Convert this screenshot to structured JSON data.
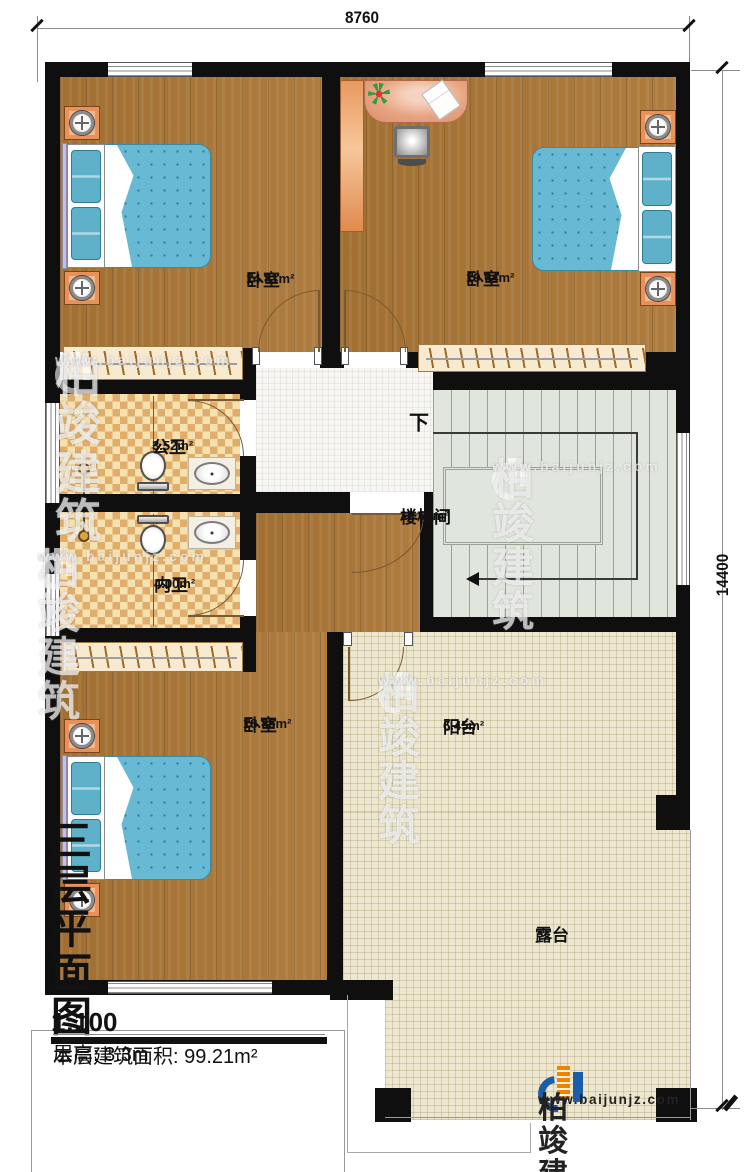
{
  "dimensions": {
    "top": "8760",
    "right": "14400"
  },
  "rooms": [
    {
      "name": "卧室",
      "area": "14.81m²"
    },
    {
      "name": "卧室",
      "area": "19.64m²"
    },
    {
      "name": "公卫",
      "area": "3.52m²"
    },
    {
      "name": "内卫",
      "area": "4.00m²"
    },
    {
      "name": "楼梯间",
      "area": "16.68m²"
    },
    {
      "name": "卧室",
      "area": "18.85m²"
    },
    {
      "name": "阳台",
      "area": "6.45m²"
    },
    {
      "name": "露台",
      "area": ""
    }
  ],
  "stairs": {
    "down_label": "下"
  },
  "title_block": {
    "title": "三层平面图",
    "scale": "1:100",
    "floor_area_label": "本层建筑面积: 99.21m²",
    "floor_height_label": "层高: 3.3m"
  },
  "branding": {
    "company": "柏竣建筑",
    "website": "www.baijunjz.com"
  },
  "colors": {
    "wall": "#0f0f0f",
    "wood_floor": "#a97534",
    "bath_tile_light": "#f6e2b0",
    "bath_tile_dark": "#e0ad6b",
    "stair_floor": "#e0e5dd",
    "outdoor_floor": "#ece7ce",
    "bed": "#68b9d4",
    "nightstand_orange": "#e8915b",
    "logo_blue": "#1b5ea8",
    "logo_orange": "#f08300"
  }
}
